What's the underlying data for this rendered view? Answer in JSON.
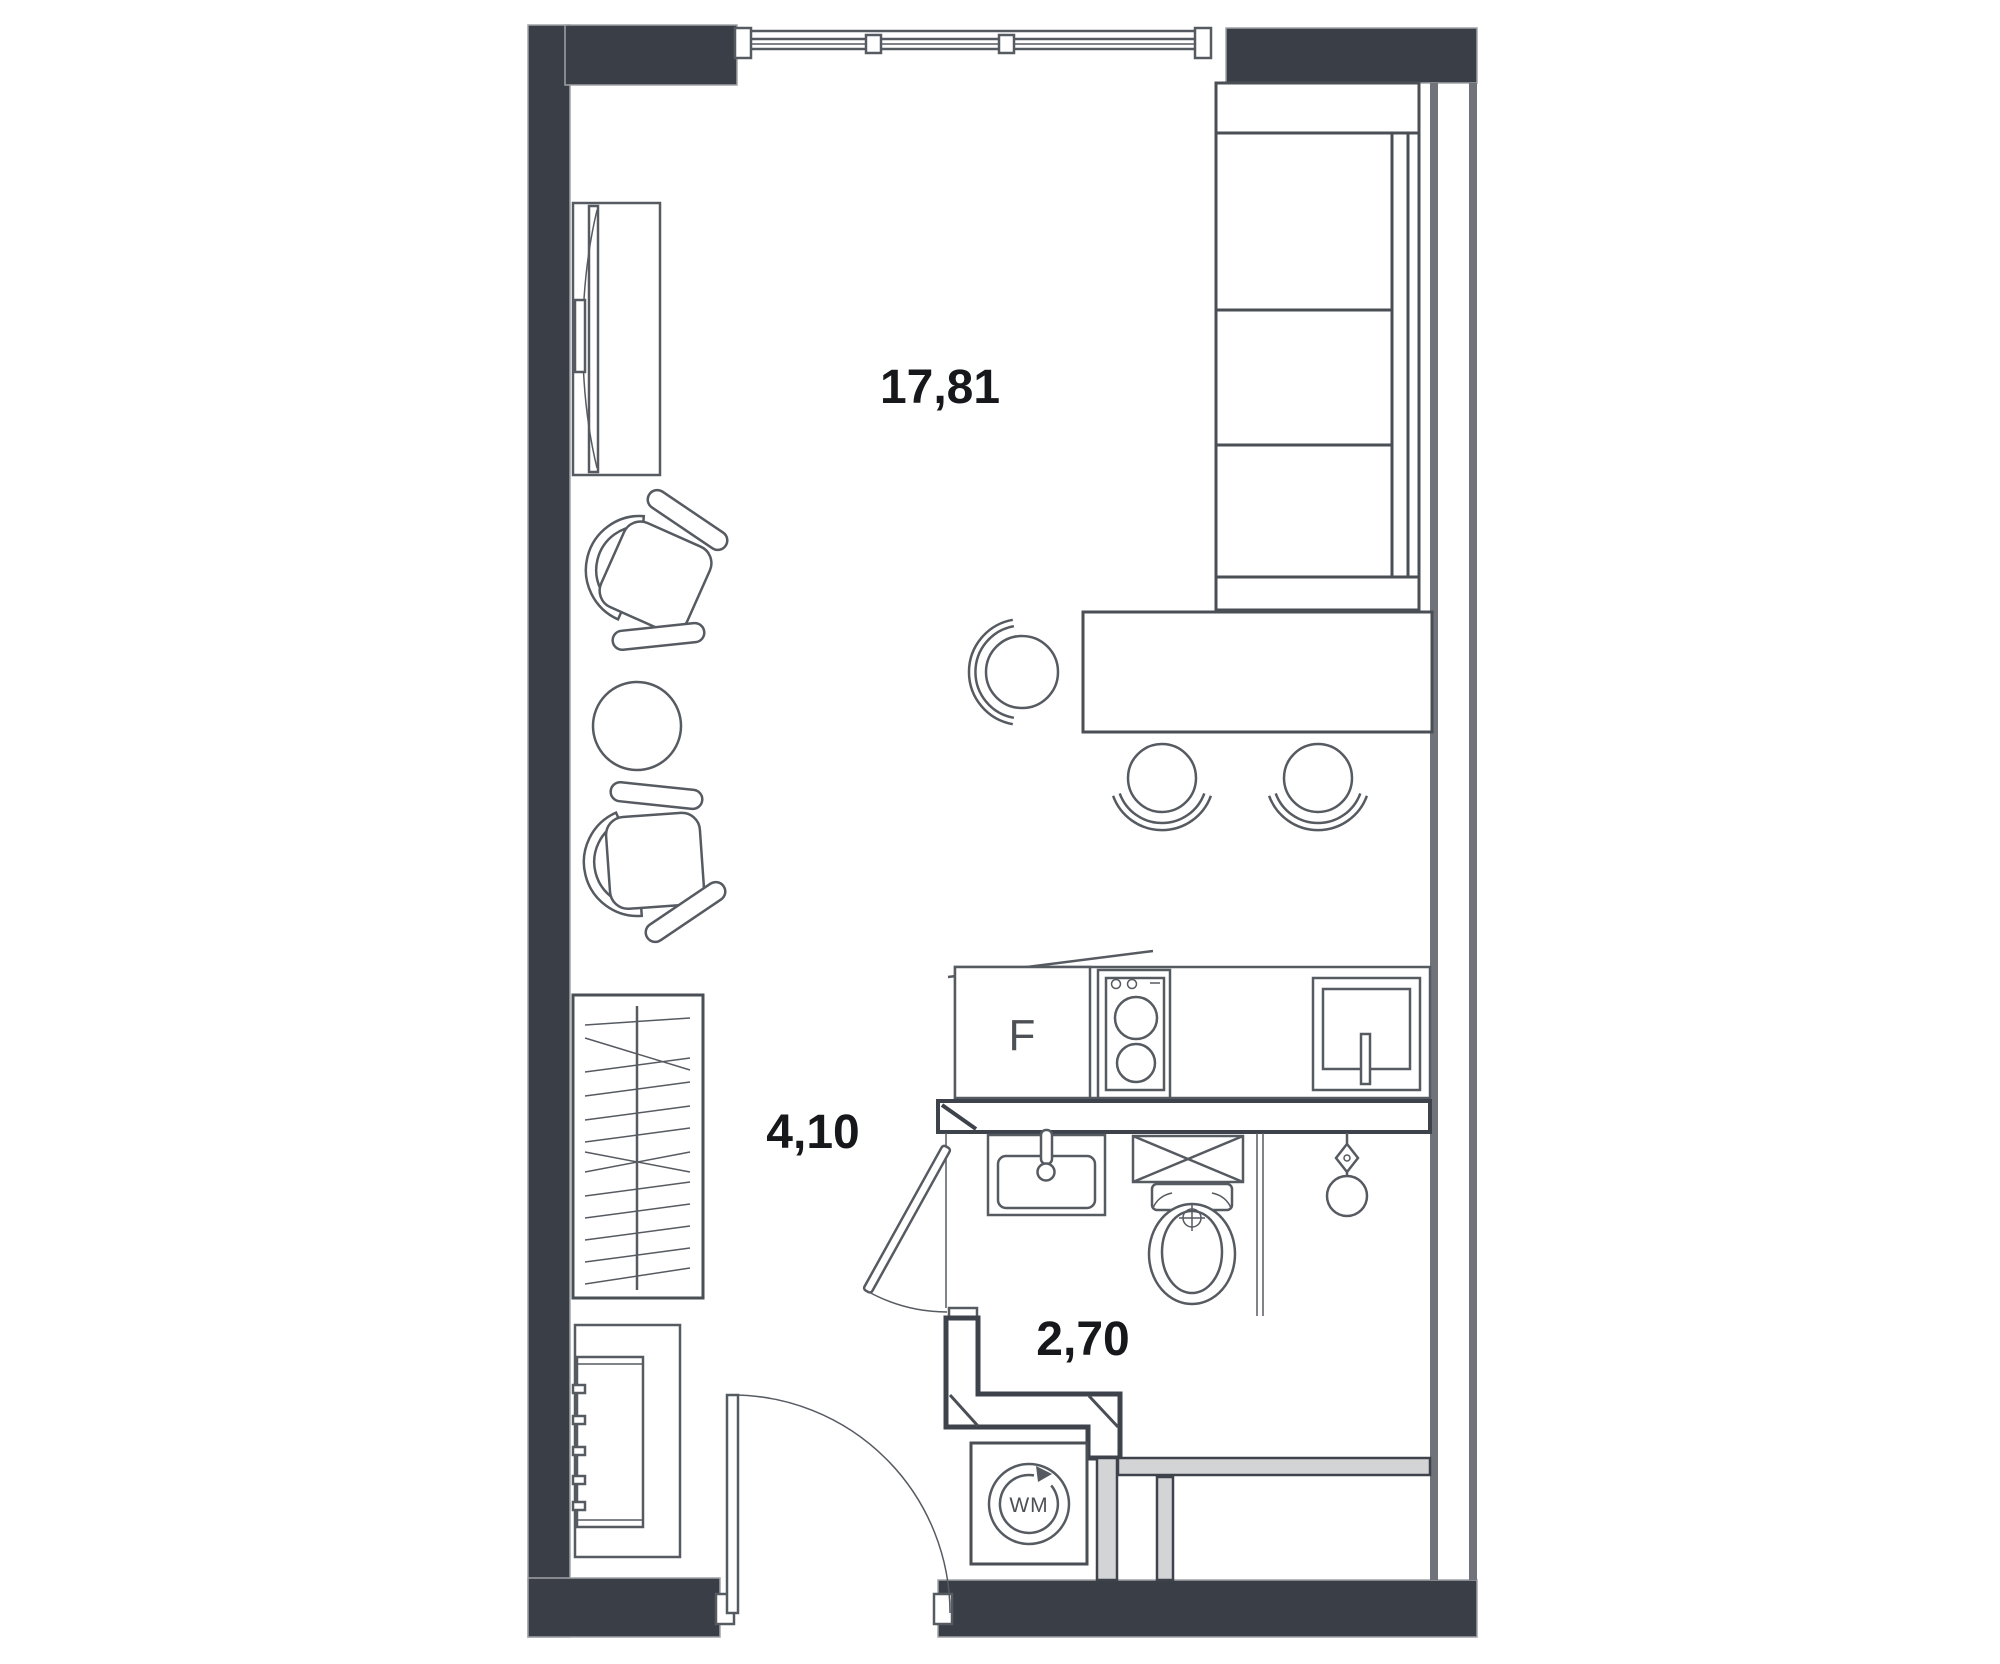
{
  "plan": {
    "type": "floor-plan-studio-apartment",
    "rooms": [
      {
        "name": "living-room",
        "area_label": "17,81"
      },
      {
        "name": "hallway",
        "area_label": "4,10"
      },
      {
        "name": "bathroom",
        "area_label": "2,70"
      }
    ],
    "appliances": {
      "fridge_label": "F",
      "washing_machine_label": "WM"
    },
    "colors": {
      "wall": "#3a3f47",
      "secondary_wall": "#707379",
      "furniture_line": "#565a61",
      "partition_light": "#d3d4d6",
      "label_text": "#17181b",
      "background": "#ffffff"
    }
  }
}
